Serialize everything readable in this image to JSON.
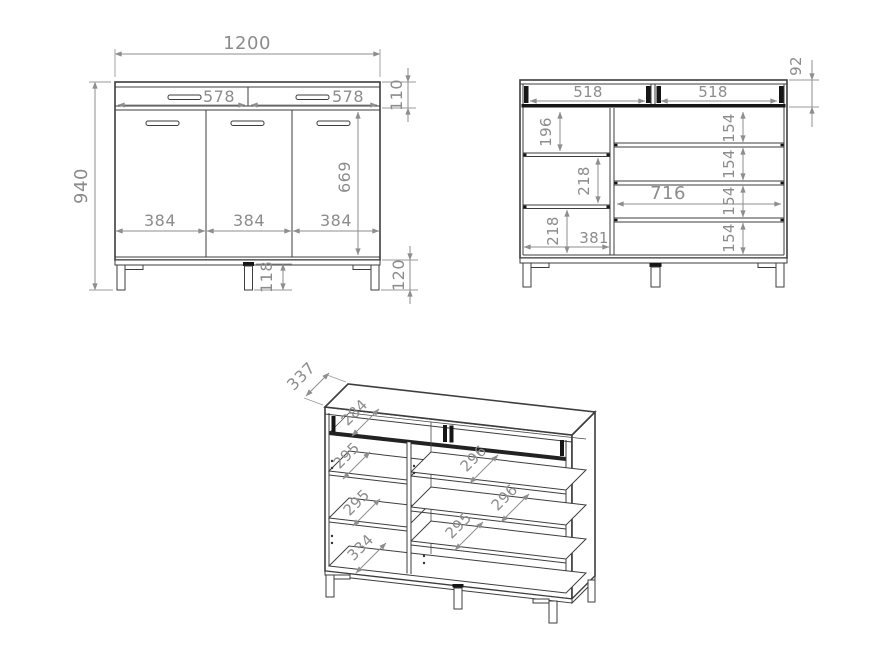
{
  "drawing": {
    "colors": {
      "line": "#3d3d3d",
      "dimension": "#8c8c8c",
      "hardware": "#161616"
    },
    "views": {
      "front": {
        "total_width": "1200",
        "total_height": "940",
        "drawer_widths": [
          "578",
          "578"
        ],
        "drawer_front_height": "110",
        "door_height": "669",
        "door_widths": [
          "384",
          "384",
          "384"
        ],
        "center_leg_height": "118",
        "leg_height": "120"
      },
      "internal_front": {
        "drawer_box_height": "92",
        "drawer_inner_widths": [
          "518",
          "518"
        ],
        "left_compartment_heights": [
          "196",
          "218",
          "218"
        ],
        "left_compartment_width": "381",
        "right_compartment_width": "716",
        "right_compartment_heights": [
          "154",
          "154",
          "154",
          "154"
        ]
      },
      "perspective": {
        "total_depth": "337",
        "drawer_inner_depth": "284",
        "left_shelf_depths": [
          "295",
          "295"
        ],
        "left_bottom_depth": "334",
        "right_shelf_depths": [
          "296",
          "296",
          "295"
        ]
      }
    }
  }
}
